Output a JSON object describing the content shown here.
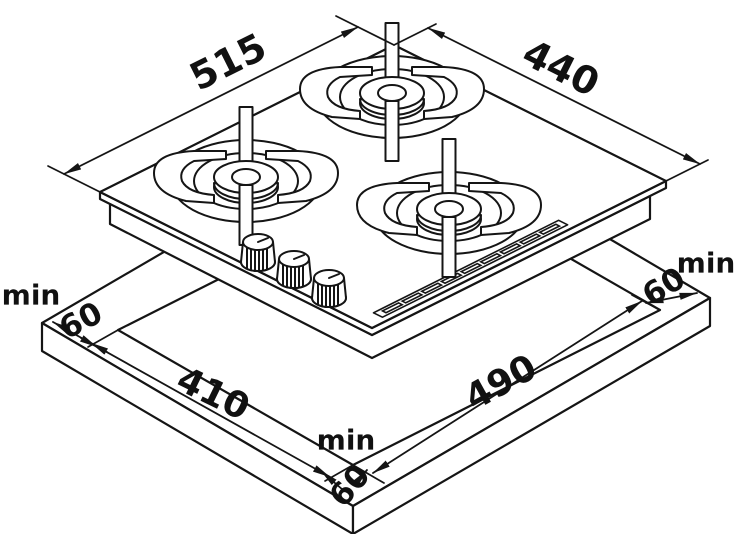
{
  "diagram": {
    "labels": {
      "hob_left_edge_mm": "515",
      "hob_right_edge_mm": "440",
      "cutout_left_edge_mm": "410",
      "cutout_right_edge_mm": "490",
      "clearance_left": {
        "prefix": "min",
        "value": "60"
      },
      "clearance_right": {
        "prefix": "min",
        "value": "60"
      },
      "clearance_front": {
        "prefix": "min",
        "value": "60"
      }
    },
    "colors": {
      "line": "#151515",
      "background": "#ffffff"
    }
  }
}
